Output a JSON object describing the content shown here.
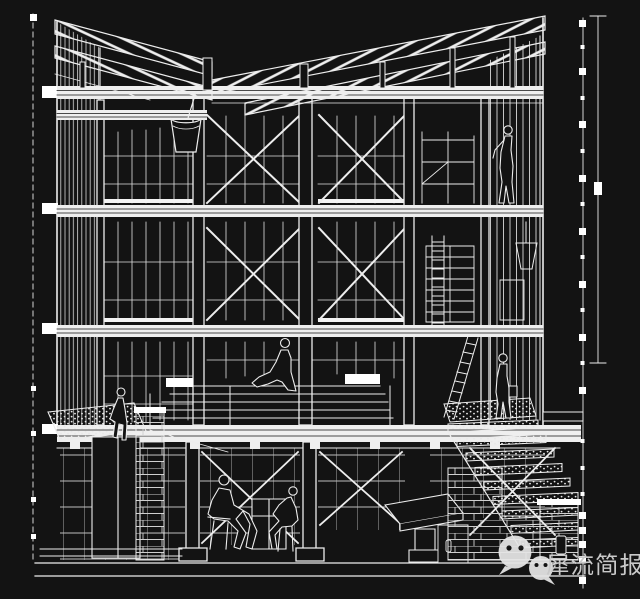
{
  "colors": {
    "background": "#131313",
    "line": "#ededed",
    "watermark_text": "#c9c9c9",
    "watermark_logo": "#e6e6e6"
  },
  "watermark": {
    "icon": "wechat-logo",
    "text": "犀流简报"
  }
}
